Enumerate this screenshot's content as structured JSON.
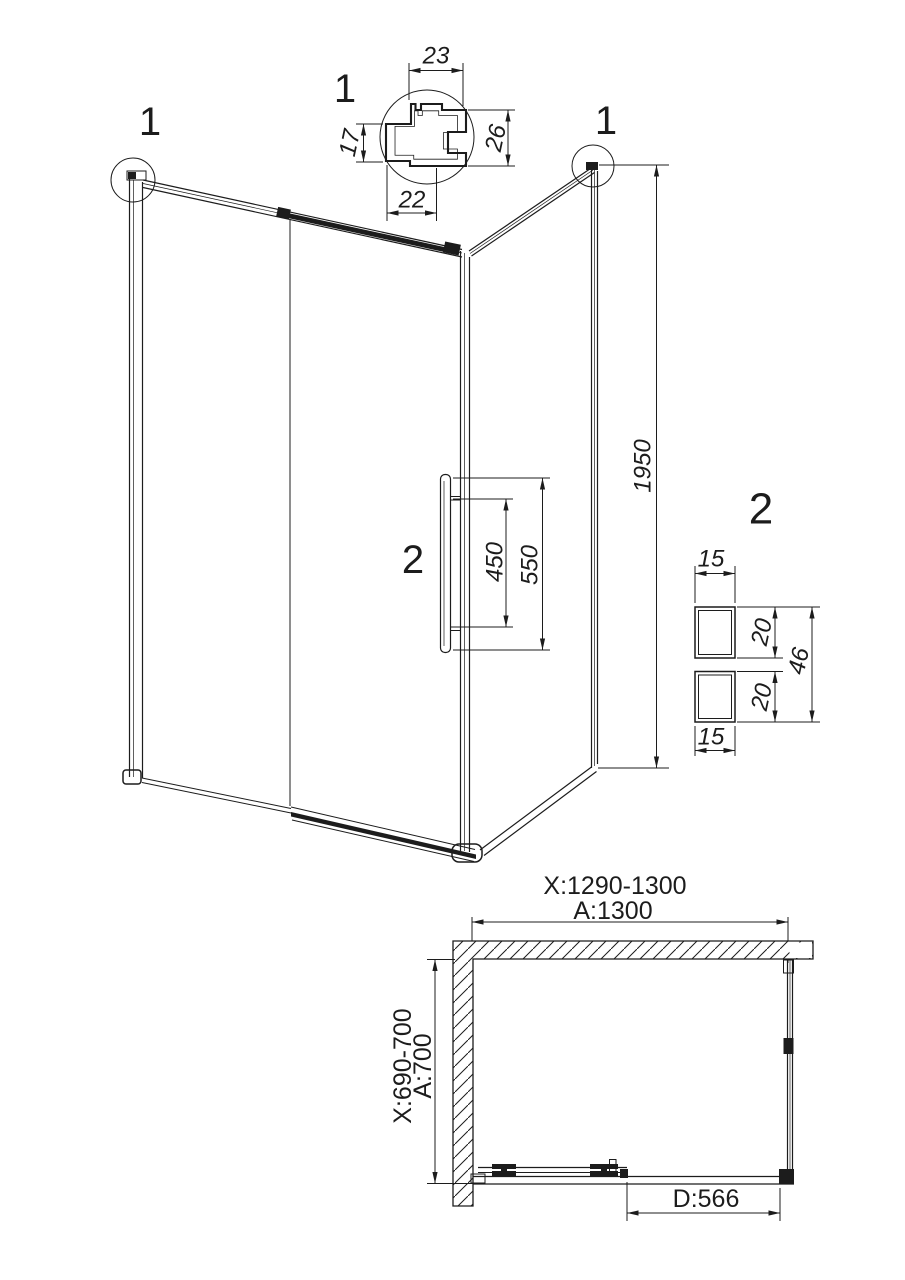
{
  "drawing": {
    "detail1": {
      "callout": "1",
      "dim_top": "23",
      "dim_left": "17",
      "dim_right": "26",
      "dim_bottom": "22"
    },
    "detail2": {
      "callout": "2",
      "dim_top": "15",
      "dim_upper": "20",
      "dim_lower": "20",
      "dim_total": "46",
      "dim_bottom": "15"
    },
    "elevation": {
      "callout_top_left": "1",
      "callout_top_right": "1",
      "callout_handle": "2",
      "dim_height": "1950",
      "dim_handle_inner": "450",
      "dim_handle_outer": "550"
    },
    "plan": {
      "dim_width_range": "X:1290-1300",
      "dim_width": "A:1300",
      "dim_depth_range": "X:690-700",
      "dim_depth": "A:700",
      "dim_door": "D:566"
    }
  },
  "colors": {
    "ink": "#1c1c1c",
    "background": "#ffffff"
  }
}
